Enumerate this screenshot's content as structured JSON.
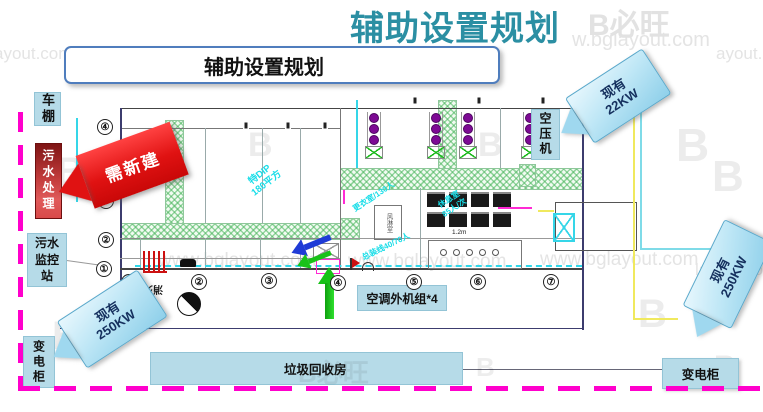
{
  "title": "辅助设置规划",
  "subtitle": "辅助设置规划",
  "watermark": {
    "url": "www.bglayout.com",
    "url_partial_left": "ayout.com",
    "url_partial_right": "ayout.co",
    "url_partial_top": "w.bglayout.com",
    "url_partial_bottom": "layout.co",
    "brand": "B必旺",
    "brand_b": "B"
  },
  "plan_labels": {
    "carport": "车棚",
    "sewage_treatment": "污水处理",
    "sewage_monitor": "污水监控站",
    "transformer_left": "变电柜",
    "air_compressor": "空压机",
    "ac_outdoor_units": "空调外机组*4",
    "garbage_room": "垃圾回收房",
    "transformer_right": "变电柜",
    "fire_hydrant": "消火栓",
    "air_shower": "风淋室",
    "dip_area_line1": "特DIP",
    "dip_area_line2": "180平方",
    "changing_room": "更衣室/130人",
    "rest_room_line1": "休息室",
    "rest_room_line2": "85人/次",
    "assembly_line": "总装线40/70人",
    "shoe_dim": "1.2m"
  },
  "callouts": {
    "need_new": "需新建",
    "existing": "现有",
    "kw22": "22KW",
    "kw250_left": "250KW",
    "kw250_right": "250KW"
  },
  "circles": {
    "left": [
      "④",
      "③",
      "②",
      "①"
    ],
    "bottom": [
      "①",
      "②",
      "③",
      "④",
      "⑤",
      "⑥",
      "⑦"
    ]
  },
  "colors": {
    "accent_teal": "#2b8fa3",
    "magenta_boundary": "#ff00cc",
    "callout_blue": "#8fd0ea",
    "alert_red": "#e01212",
    "hatch_green": "#46b45a",
    "label_blue": "#b6dbe8"
  }
}
